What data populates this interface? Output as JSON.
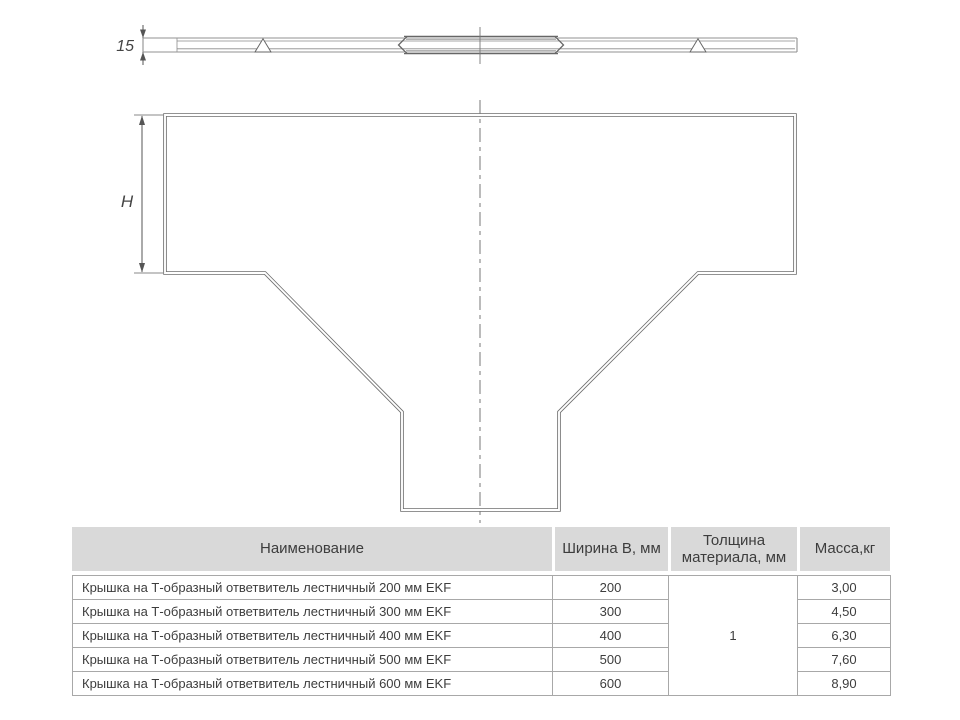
{
  "drawing": {
    "thickness_label": "15",
    "height_label": "H"
  },
  "table": {
    "headers": {
      "name": "Наименование",
      "width": "Ширина В, мм",
      "thickness": "Толщина материала, мм",
      "mass": "Масса,кг"
    },
    "thickness_value": "1",
    "rows": [
      {
        "name": "Крышка на Т-образный ответвитель лестничный 200 мм EKF",
        "width": "200",
        "mass": "3,00"
      },
      {
        "name": "Крышка на Т-образный ответвитель лестничный 300 мм EKF",
        "width": "300",
        "mass": "4,50"
      },
      {
        "name": "Крышка на Т-образный ответвитель лестничный 400 мм EKF",
        "width": "400",
        "mass": "6,30"
      },
      {
        "name": "Крышка на Т-образный ответвитель лестничный 500 мм EKF",
        "width": "500",
        "mass": "7,60"
      },
      {
        "name": "Крышка на Т-образный ответвитель лестничный 600 мм EKF",
        "width": "600",
        "mass": "8,90"
      }
    ]
  },
  "colors": {
    "header_bg": "#d9d9d9",
    "table_border": "#a8a8a8",
    "text": "#3d3d3d",
    "drawing_line_dark": "#6f6f6f",
    "drawing_line_light": "#909090"
  }
}
